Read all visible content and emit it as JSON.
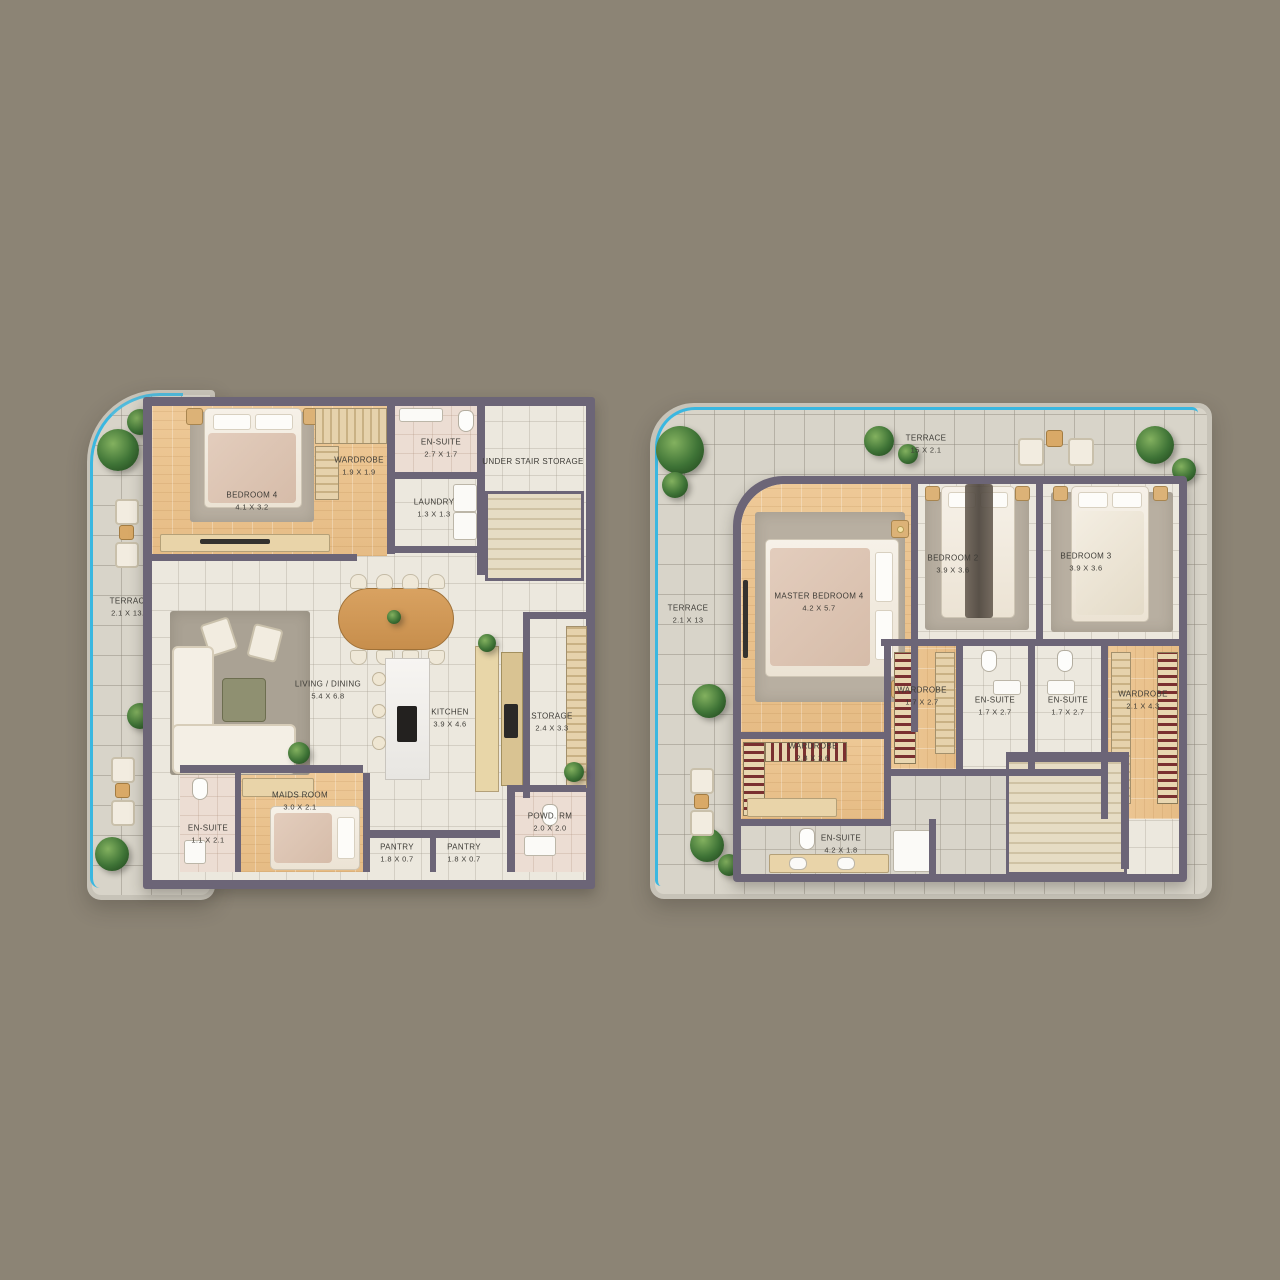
{
  "colors": {
    "background": "#8c8475",
    "wall": "#6c6577",
    "terrace_tile": "#d8d4c9",
    "interior_tile": "#ece8de",
    "wood_floor": "#eac491",
    "ensuite_floor": "#ecddd3",
    "rug": "#b8afa1",
    "water_edge": "#3ab7e0",
    "plant": "#3e7336"
  },
  "plans": [
    {
      "id": "floor-a",
      "terrace": {
        "label": "TERRACE",
        "dims": "2.1 X 13.0"
      },
      "rooms": {
        "bedroom4": {
          "label": "BEDROOM 4",
          "dims": "4.1 X 3.2"
        },
        "wardrobe": {
          "label": "WARDROBE",
          "dims": "1.9 X 1.9"
        },
        "ensuite_top": {
          "label": "EN-SUITE",
          "dims": "2.7 X 1.7"
        },
        "under_stair_storage": {
          "label": "UNDER STAIR STORAGE",
          "dims": ""
        },
        "laundry": {
          "label": "LAUNDRY",
          "dims": "1.3 X 1.3"
        },
        "living_dining": {
          "label": "LIVING / DINING",
          "dims": "5.4 X 6.8"
        },
        "kitchen": {
          "label": "KITCHEN",
          "dims": "3.9 X 4.6"
        },
        "storage": {
          "label": "STORAGE",
          "dims": "2.4 X 3.3"
        },
        "maids_room": {
          "label": "MAIDS ROOM",
          "dims": "3.0 X 2.1"
        },
        "ensuite_lower": {
          "label": "EN-SUITE",
          "dims": "1.1 X 2.1"
        },
        "pantry_left": {
          "label": "PANTRY",
          "dims": "1.8 X 0.7"
        },
        "pantry_right": {
          "label": "PANTRY",
          "dims": "1.8 X 0.7"
        },
        "powder_room": {
          "label": "POWD. RM",
          "dims": "2.0 X 2.0"
        }
      }
    },
    {
      "id": "floor-b",
      "terrace_top": {
        "label": "TERRACE",
        "dims": "15 X 2.1"
      },
      "terrace_side": {
        "label": "TERRACE",
        "dims": "2.1 X 13"
      },
      "rooms": {
        "master_bedroom": {
          "label": "MASTER BEDROOM 4",
          "dims": "4.2 X 5.7"
        },
        "bedroom2": {
          "label": "BEDROOM 2",
          "dims": "3.9 X 3.6"
        },
        "bedroom3": {
          "label": "BEDROOM 3",
          "dims": "3.9 X 3.6"
        },
        "wardrobe_mid": {
          "label": "WARDROBE",
          "dims": "1.7 X 2.7"
        },
        "ensuite_bed2": {
          "label": "EN-SUITE",
          "dims": "1.7 X 2.7"
        },
        "ensuite_bed3": {
          "label": "EN-SUITE",
          "dims": "1.7 X 2.7"
        },
        "wardrobe_right": {
          "label": "WARDROBE",
          "dims": "2.1 X 4.3"
        },
        "wardrobe_master": {
          "label": "WARDROBE",
          "dims": "2.8 X 2.6"
        },
        "ensuite_master": {
          "label": "EN-SUITE",
          "dims": "4.2 X 1.8"
        }
      }
    }
  ]
}
